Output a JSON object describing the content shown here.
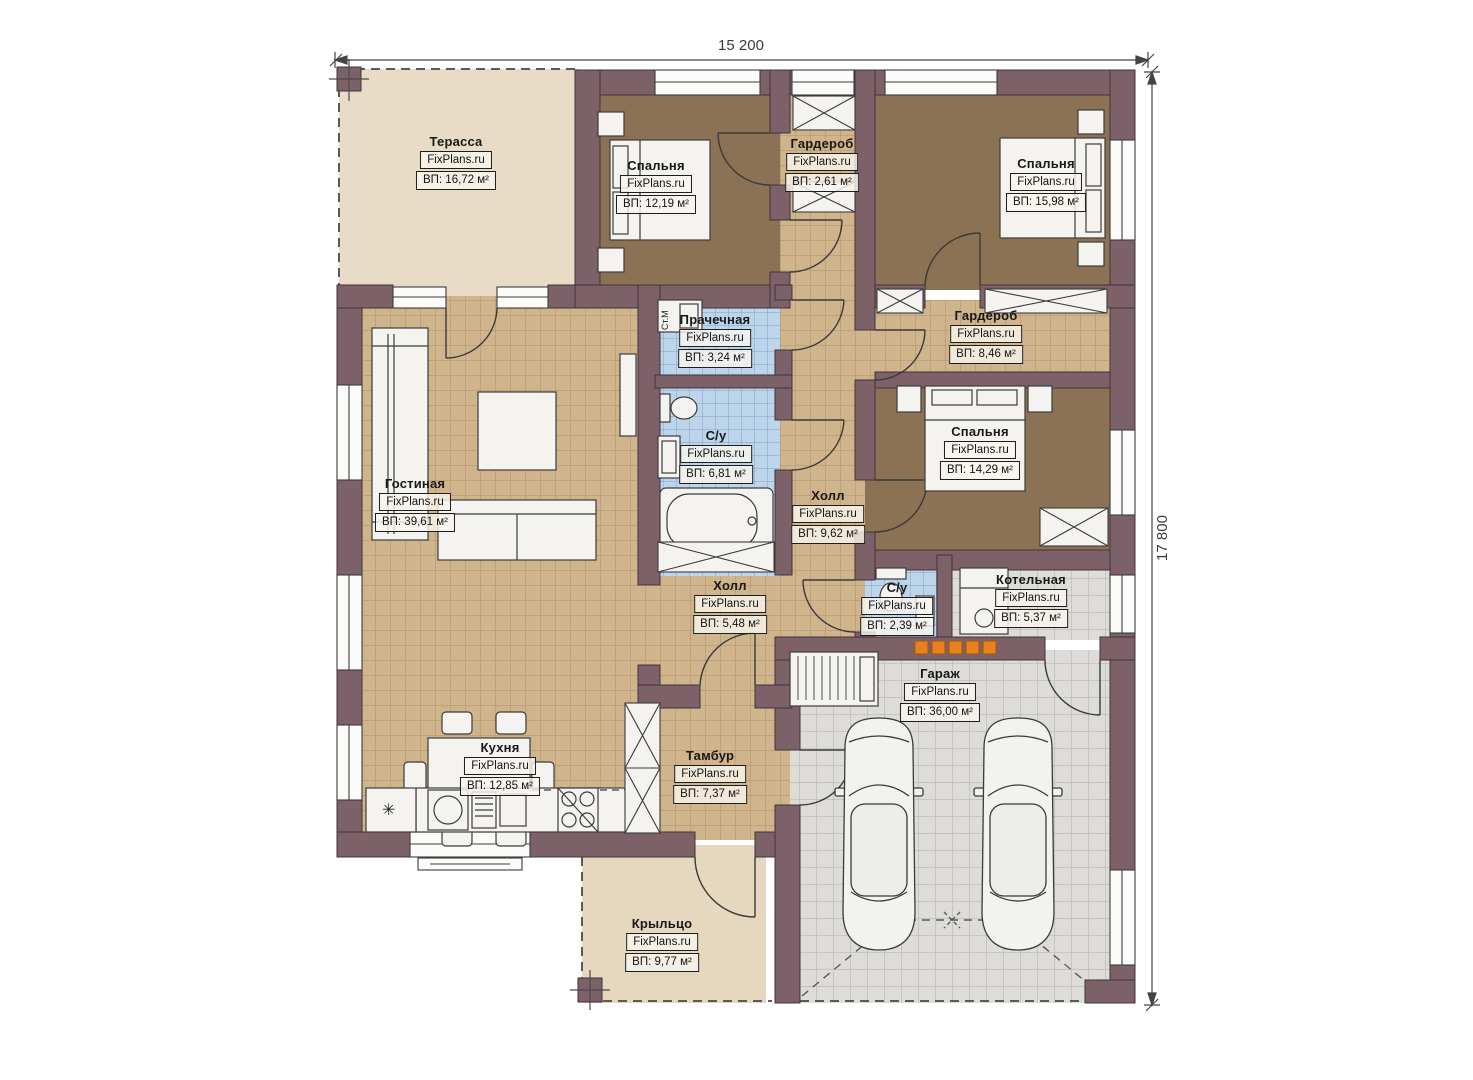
{
  "plan": {
    "brand": "FixPlans.ru",
    "dimensions": {
      "width_label": "15 200",
      "height_label": "17 800"
    },
    "annotations": {
      "washing_machine": "Ст.М"
    },
    "rooms": [
      {
        "id": "terrace",
        "name": "Терасса",
        "area": "ВП: 16,72 м²"
      },
      {
        "id": "bedroom-1",
        "name": "Спальня",
        "area": "ВП: 12,19 м²"
      },
      {
        "id": "wardrobe-1",
        "name": "Гардероб",
        "area": "ВП: 2,61 м²"
      },
      {
        "id": "bedroom-2",
        "name": "Спальня",
        "area": "ВП: 15,98 м²"
      },
      {
        "id": "laundry",
        "name": "Прачечная",
        "area": "ВП: 3,24 м²"
      },
      {
        "id": "wardrobe-2",
        "name": "Гардероб",
        "area": "ВП: 8,46 м²"
      },
      {
        "id": "bathroom-1",
        "name": "С/у",
        "area": "ВП: 6,81 м²"
      },
      {
        "id": "bedroom-3",
        "name": "Спальня",
        "area": "ВП: 14,29 м²"
      },
      {
        "id": "hall-1",
        "name": "Холл",
        "area": "ВП: 9,62 м²"
      },
      {
        "id": "living",
        "name": "Гостиная",
        "area": "ВП: 39,61 м²"
      },
      {
        "id": "hall-2",
        "name": "Холл",
        "area": "ВП: 5,48 м²"
      },
      {
        "id": "bathroom-2",
        "name": "С/у",
        "area": "ВП: 2,39 м²"
      },
      {
        "id": "boiler",
        "name": "Котельная",
        "area": "ВП: 5,37 м²"
      },
      {
        "id": "garage",
        "name": "Гараж",
        "area": "ВП: 36,00 м²"
      },
      {
        "id": "kitchen",
        "name": "Кухня",
        "area": "ВП: 12,85 м²"
      },
      {
        "id": "vestibule",
        "name": "Тамбур",
        "area": "ВП: 7,37 м²"
      },
      {
        "id": "porch",
        "name": "Крыльцо",
        "area": "ВП: 9,77 м²"
      }
    ],
    "colors": {
      "wall": "#7c6169",
      "wall_outline": "#43333a",
      "tile_tan": "#cfb48c",
      "tile_blue": "#bdd5ea",
      "tile_gray": "#dddcd8",
      "floor_bedroom": "#8b7254",
      "terrace": "#e8dcc6",
      "porch": "#e6d7bf",
      "fixture": "#f4f3f0",
      "vent": "#e8801e"
    }
  }
}
